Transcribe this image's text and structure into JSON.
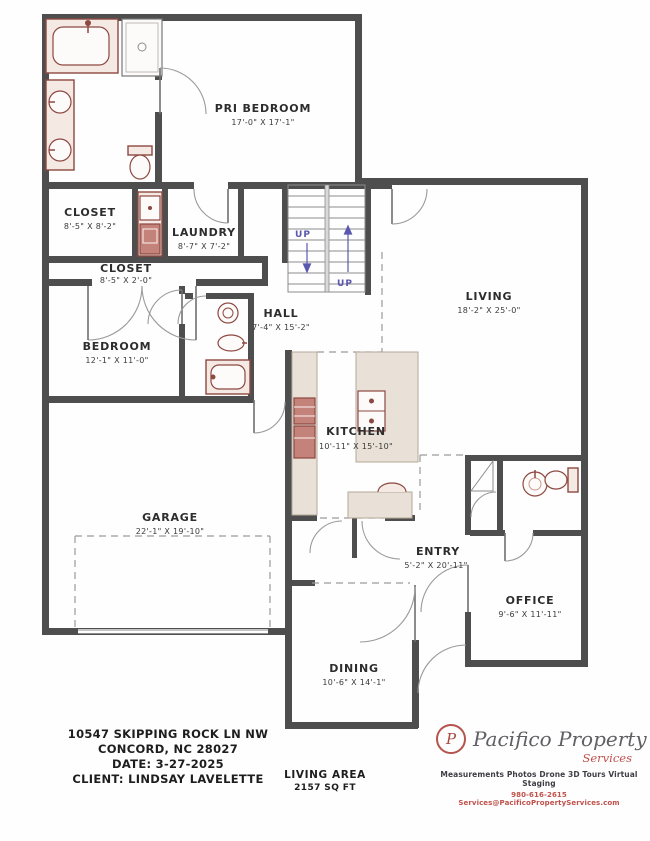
{
  "plan": {
    "wall_color": "#4e4e4e",
    "fixture_color": "#8d4840",
    "counter_color": "#e9e1d7",
    "stairs_up_color": "#5a58ae",
    "rooms": {
      "pri_bedroom": {
        "name": "PRI BEDROOM",
        "dims": "17'-0\" X 17'-1\""
      },
      "closet_1": {
        "name": "CLOSET",
        "dims": "8'-5\" X 8'-2\""
      },
      "laundry": {
        "name": "LAUNDRY",
        "dims": "8'-7\" X 7'-2\""
      },
      "closet_2": {
        "name": "CLOSET",
        "dims": "8'-5\" X 2'-0\""
      },
      "hall": {
        "name": "HALL",
        "dims": "7'-4\" X 15'-2\""
      },
      "living": {
        "name": "LIVING",
        "dims": "18'-2\" X 25'-0\""
      },
      "bedroom": {
        "name": "BEDROOM",
        "dims": "12'-1\" X 11'-0\""
      },
      "kitchen": {
        "name": "KITCHEN",
        "dims": "10'-11\" X 15'-10\""
      },
      "garage": {
        "name": "GARAGE",
        "dims": "22'-1\" X 19'-10\""
      },
      "entry": {
        "name": "ENTRY",
        "dims": "5'-2\" X 20'-11\""
      },
      "office": {
        "name": "OFFICE",
        "dims": "9'-6\" X 11'-11\""
      },
      "dining": {
        "name": "DINING",
        "dims": "10'-6\" X 14'-1\""
      }
    },
    "stairs": {
      "up_label_1": "UP",
      "up_label_2": "UP"
    }
  },
  "footer": {
    "address_line_1": "10547 SKIPPING ROCK LN NW",
    "address_line_2": "CONCORD, NC 28027",
    "date_line": "DATE: 3-27-2025",
    "client_line": "CLIENT: LINDSAY LAVELETTE",
    "living_area_label": "LIVING AREA",
    "living_area_value": "2157 SQ FT"
  },
  "branding": {
    "logo_letter": "P",
    "company_name": "Pacifico Property",
    "company_sub": "Services",
    "tagline": "Measurements Photos Drone 3D Tours Virtual Staging",
    "contact": "980-616-2615 Services@PacificoPropertyServices.com",
    "accent_color": "#c0504d"
  }
}
